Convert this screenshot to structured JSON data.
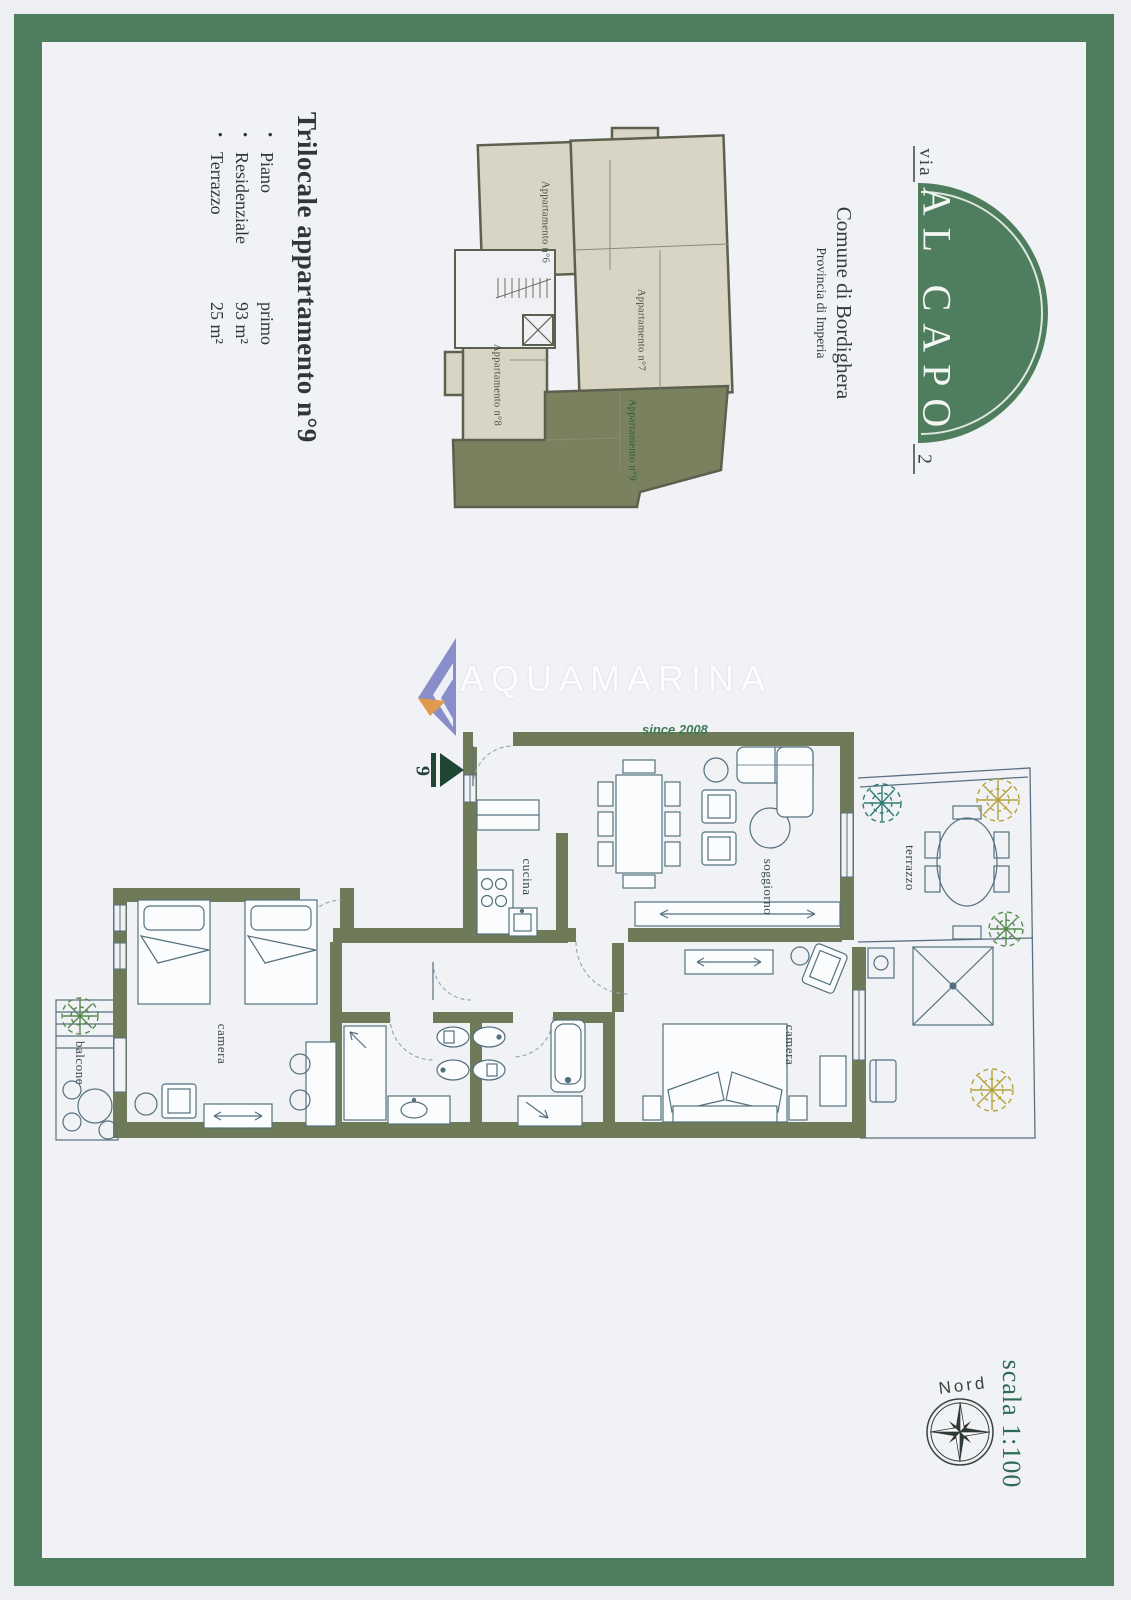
{
  "logo": {
    "via": "via",
    "name": "AL CAPO",
    "number": "2"
  },
  "municipality": {
    "name": "Comune di Bordighera",
    "province": "Provincia di Imperia"
  },
  "listing": {
    "title": "Trilocale appartamento n°9",
    "bullet": "•",
    "details": [
      {
        "label": "Piano",
        "value": "primo"
      },
      {
        "label": "Residenziale",
        "value": "93 m²"
      },
      {
        "label": "Terrazzo",
        "value": "25 m²"
      }
    ]
  },
  "overview": {
    "apartments": [
      {
        "label": "Appartamento n°6"
      },
      {
        "label": "Appartamento n°7"
      },
      {
        "label": "Appartamento n°8"
      },
      {
        "label": "Appartamento n°9"
      }
    ]
  },
  "watermark": {
    "brand": "AQUAMARINA",
    "tagline": "REAL ESTATE AGENCY",
    "since": "since 2008"
  },
  "plan": {
    "entry_number": "9",
    "rooms": {
      "cucina": "cucina",
      "soggiorno": "soggiorno",
      "terrazzo": "terrazzo",
      "camera_right": "camera",
      "camera_left": "camera",
      "balcone": "balcone"
    }
  },
  "footer": {
    "north": "Nord",
    "scale": "scala 1:100"
  },
  "colors": {
    "frame_green": "#4f7e5e",
    "wall_olive": "#6f7b58",
    "apartment9_green": "#7a815f",
    "overview_beige": "#d9d5c4",
    "plan_line": "#4e6b7a",
    "scale_text": "#2e6b52",
    "watermark_blue": "#7e86c4",
    "watermark_orange": "#e09a4e"
  }
}
